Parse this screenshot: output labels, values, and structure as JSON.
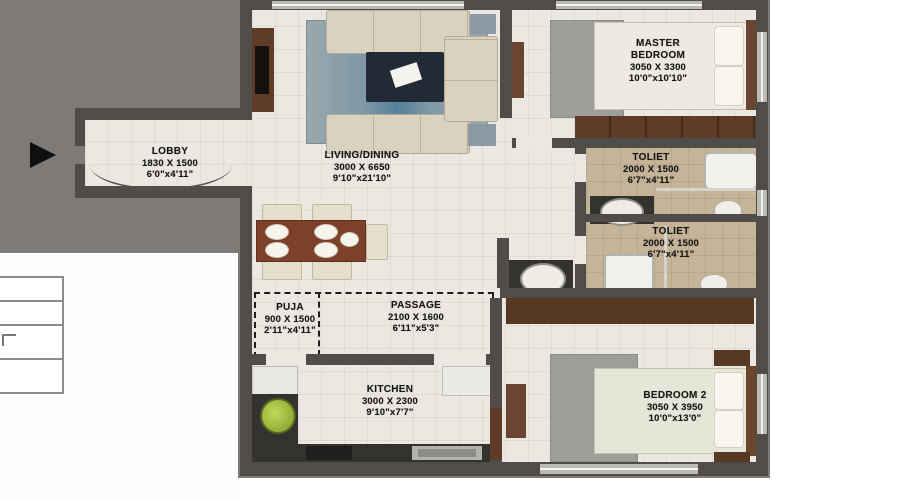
{
  "plan": {
    "type": "apartment-floor-plan-2bhk",
    "entrance_icon": "entrance-arrow",
    "colors": {
      "backdrop": "#7d7a77",
      "wall": "#4f4c49",
      "floor": "#ebe8e1",
      "toilet_floor": "#c6b498",
      "wood": "#5e3c27",
      "counter": "#34322f",
      "rug": "#9e9e9a",
      "accent_green": "#a6c23c",
      "label_text": "#161616"
    },
    "rooms": [
      {
        "id": "lobby",
        "name": "LOBBY",
        "dim_mm": "1830 X 1500",
        "dim_ft": "6'0\"x4'11\""
      },
      {
        "id": "living-dining",
        "name": "LIVING/DINING",
        "dim_mm": "3000 X 6650",
        "dim_ft": "9'10\"x21'10\""
      },
      {
        "id": "master-bedroom",
        "name": "MASTER BEDROOM",
        "dim_mm": "3050 X 3300",
        "dim_ft": "10'0\"x10'10\""
      },
      {
        "id": "toilet-1",
        "name": "TOLIET",
        "dim_mm": "2000 X 1500",
        "dim_ft": "6'7\"x4'11\""
      },
      {
        "id": "toilet-2",
        "name": "TOLIET",
        "dim_mm": "2000 X 1500",
        "dim_ft": "6'7\"x4'11\""
      },
      {
        "id": "puja",
        "name": "PUJA",
        "dim_mm": "900 X 1500",
        "dim_ft": "2'11\"x4'11\""
      },
      {
        "id": "passage",
        "name": "PASSAGE",
        "dim_mm": "2100 X 1600",
        "dim_ft": "6'11\"x5'3\""
      },
      {
        "id": "kitchen",
        "name": "KITCHEN",
        "dim_mm": "3000 X 2300",
        "dim_ft": "9'10\"x7'7\""
      },
      {
        "id": "bedroom-2",
        "name": "BEDROOM 2",
        "dim_mm": "3050 X 3950",
        "dim_ft": "10'0\"x13'0\""
      }
    ]
  }
}
